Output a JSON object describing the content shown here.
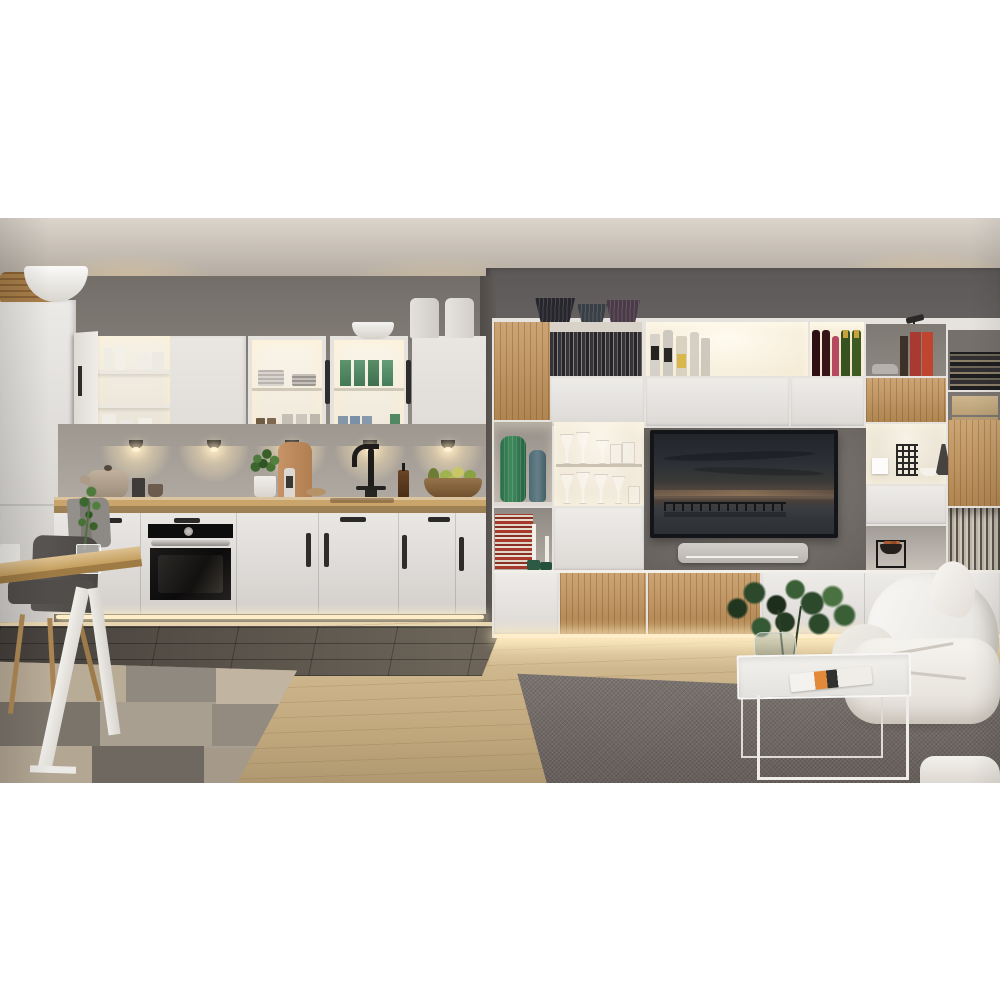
{
  "image_type": "interior-photograph",
  "scene": {
    "description": "Modern open-plan interior: white kitchen with lit glass cabinets, wall unit with TV and oak accents, dining table and white lounge chair",
    "areas": {
      "kitchen": {
        "objects": [
          "tall-pantry-cabinet",
          "wicker-basket",
          "large-white-bowl",
          "open-wall-cabinet",
          "white-bottles",
          "glass-door-cabinet-plates",
          "glass-door-cabinet-green-glasses",
          "blue-glasses",
          "ceramic-canisters",
          "small-bowl",
          "under-cabinet-puck-lights",
          "teapot",
          "black-mug",
          "small-cup",
          "grey-towel",
          "cutting-board",
          "basil-plant",
          "pepper-grinder",
          "black-faucet",
          "sink",
          "soap-bottle",
          "fruit-bowl-with-pears",
          "built-in-oven",
          "toe-kick-led",
          "dark-floor-tiles"
        ]
      },
      "living_room": {
        "objects": [
          "wall-unit",
          "oak-door-panels",
          "vinyl-record-collection",
          "liquor-bottles",
          "red-wine-bottles",
          "rose-wine-bottle",
          "champagne-bottles",
          "red-books",
          "stacked-books",
          "toy-car",
          "wooden-boxes",
          "decorative-grass-vases",
          "task-lamp",
          "green-vase",
          "teal-vase",
          "wine-glasses",
          "television",
          "seascape-picture",
          "soundbar",
          "white-speaker-cube",
          "metal-sculpture",
          "white-bowl",
          "dark-ceramic-vase",
          "black-cube-bowl",
          "striped-books",
          "candles",
          "under-unit-led",
          "white-lounge-chair",
          "white-throw",
          "wire-frame-coffee-table",
          "eucalyptus-in-glass-vase",
          "magazine",
          "dark-grey-rug",
          "oak-wood-floor"
        ]
      },
      "dining": {
        "objects": [
          "oak-table",
          "white-trestle-leg",
          "grey-upholstered-chair",
          "wood-chair-legs",
          "glass-with-green-sprig",
          "white-cup",
          "patchwork-rug"
        ]
      }
    }
  },
  "palette": {
    "page_bg": "#ffffff",
    "ceiling": "#cfc5b9",
    "wall": "#8d8680",
    "wall_right": "#767170",
    "cabinet_white": "#e4e1dd",
    "unit_frame": "#e6e3df",
    "backsplash": "#aba49c",
    "counter_wood": "#c9a56c",
    "oak_accent": "#c3945a",
    "tile_dark": "#544e48",
    "wood_floor": "#ccb183",
    "rug_left": "#a59c8e",
    "rug_right": "#6e6662",
    "sofa_white": "#f3f0eb",
    "tv_panel": "#7c7671",
    "tv_bezel": "#141518",
    "led_glow": "#ffeec9",
    "vase_green": "#2e7a50",
    "plant_green": "#3c5f33",
    "table_wood": "#cfa763"
  }
}
